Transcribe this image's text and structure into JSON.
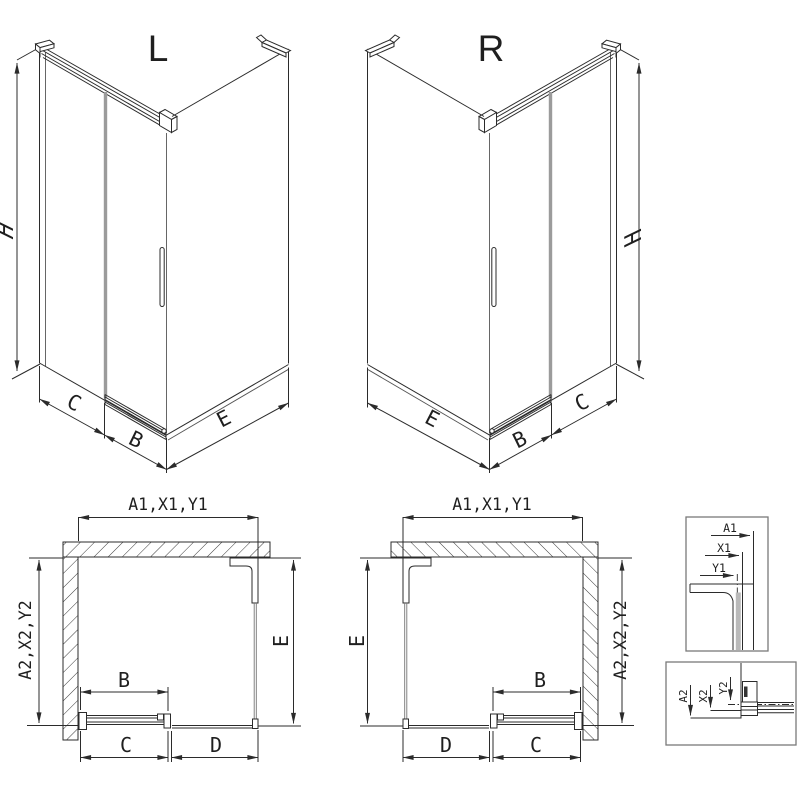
{
  "page": {
    "background": "#ffffff"
  },
  "views": {
    "iso_left": {
      "label": "L",
      "dim_height": "H",
      "dim_side": "C",
      "dim_door": "B",
      "dim_front": "E"
    },
    "iso_right": {
      "label": "R",
      "dim_height": "H",
      "dim_side": "C",
      "dim_door": "B",
      "dim_front": "E"
    },
    "plan_left": {
      "dim_top": "A1,X1,Y1",
      "dim_left": "A2,X2,Y2",
      "dim_right": "E",
      "dim_door": "B",
      "dim_bottom_inner": "C",
      "dim_bottom_outer": "D"
    },
    "plan_right": {
      "dim_top": "A1,X1,Y1",
      "dim_left": "E",
      "dim_right": "A2,X2,Y2",
      "dim_door": "B",
      "dim_bottom_outer": "D",
      "dim_bottom_inner": "C"
    },
    "detail_top_profile": {
      "dim_overall": "A1",
      "dim_mid": "X1",
      "dim_inner": "Y1"
    },
    "detail_bottom_rail": {
      "dim_overall": "A2",
      "dim_mid": "X2",
      "dim_inner": "Y2"
    }
  },
  "colors": {
    "line": "#2b2b2b",
    "glass_edge": "#9b9b9b",
    "detail_border": "#7a7a7a",
    "hatch": "#3a3a3a",
    "text": "#1f1f1f"
  }
}
